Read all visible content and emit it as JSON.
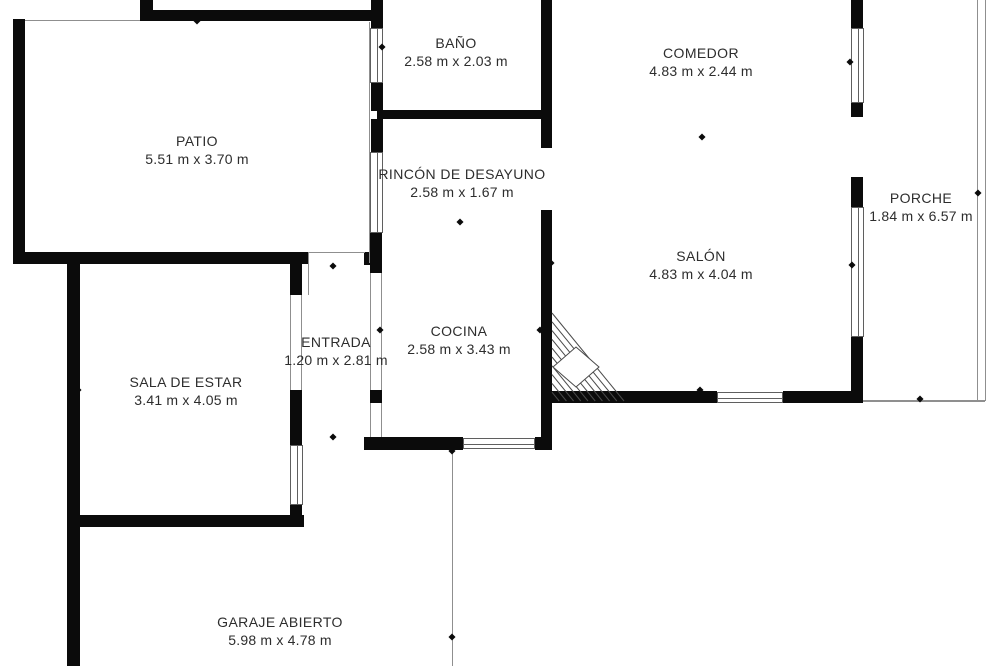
{
  "meta": {
    "width": 1000,
    "height": 666,
    "background_color": "#ffffff",
    "wall_color": "#0b0b0b",
    "thin_line_color": "#8f8f8f",
    "text_color": "#2d2d2d"
  },
  "rooms": [
    {
      "id": "patio",
      "name": "PATIO",
      "dims": "5.51 m x 3.70 m",
      "cx": 197,
      "cy": 150
    },
    {
      "id": "bano",
      "name": "BAÑO",
      "dims": "2.58 m x 2.03 m",
      "cx": 456,
      "cy": 52
    },
    {
      "id": "comedor",
      "name": "COMEDOR",
      "dims": "4.83 m x 2.44 m",
      "cx": 701,
      "cy": 62
    },
    {
      "id": "rincon",
      "name": "RINCÓN DE DESAYUNO",
      "dims": "2.58 m x 1.67 m",
      "cx": 462,
      "cy": 183
    },
    {
      "id": "salon",
      "name": "SALÓN",
      "dims": "4.83 m x 4.04 m",
      "cx": 701,
      "cy": 265
    },
    {
      "id": "porche",
      "name": "PORCHE",
      "dims": "1.84 m x 6.57 m",
      "cx": 921,
      "cy": 207
    },
    {
      "id": "entrada",
      "name": "ENTRADA",
      "dims": "1.20 m x 2.81 m",
      "cx": 336,
      "cy": 351
    },
    {
      "id": "cocina",
      "name": "COCINA",
      "dims": "2.58 m x 3.43 m",
      "cx": 459,
      "cy": 340
    },
    {
      "id": "sala",
      "name": "SALA DE ESTAR",
      "dims": "3.41 m x 4.05 m",
      "cx": 186,
      "cy": 391
    },
    {
      "id": "garaje",
      "name": "GARAJE ABIERTO",
      "dims": "5.98 m x 4.78 m",
      "cx": 280,
      "cy": 631
    }
  ],
  "walls": [
    [
      140,
      0,
      13,
      10
    ],
    [
      371,
      0,
      12,
      10
    ],
    [
      140,
      10,
      243,
      11
    ],
    [
      13,
      19,
      12,
      245
    ],
    [
      13,
      252,
      295,
      12
    ],
    [
      67,
      264,
      13,
      402
    ],
    [
      80,
      515,
      224,
      12
    ],
    [
      290,
      264,
      12,
      31
    ],
    [
      290,
      390,
      12,
      55
    ],
    [
      290,
      505,
      12,
      22
    ],
    [
      364,
      252,
      18,
      13
    ],
    [
      370,
      233,
      12,
      40
    ],
    [
      370,
      390,
      12,
      13
    ],
    [
      371,
      21,
      12,
      8
    ],
    [
      371,
      83,
      12,
      28
    ],
    [
      377,
      110,
      165,
      9
    ],
    [
      371,
      119,
      12,
      33
    ],
    [
      541,
      0,
      11,
      148
    ],
    [
      541,
      210,
      11,
      237
    ],
    [
      364,
      437,
      99,
      13
    ],
    [
      535,
      437,
      17,
      13
    ],
    [
      548,
      391,
      169,
      12
    ],
    [
      783,
      391,
      80,
      12
    ],
    [
      851,
      0,
      12,
      28
    ],
    [
      851,
      103,
      12,
      14
    ],
    [
      851,
      177,
      12,
      30
    ],
    [
      851,
      337,
      12,
      66
    ]
  ],
  "windows": [
    {
      "x": 370,
      "y": 28,
      "w": 13,
      "h": 55,
      "orient": "v"
    },
    {
      "x": 370,
      "y": 152,
      "w": 13,
      "h": 81,
      "orient": "v"
    },
    {
      "x": 851,
      "y": 28,
      "w": 13,
      "h": 75,
      "orient": "v"
    },
    {
      "x": 851,
      "y": 207,
      "w": 13,
      "h": 130,
      "orient": "v"
    },
    {
      "x": 290,
      "y": 445,
      "w": 13,
      "h": 60,
      "orient": "v"
    },
    {
      "x": 463,
      "y": 438,
      "w": 72,
      "h": 11,
      "orient": "h"
    },
    {
      "x": 717,
      "y": 392,
      "w": 66,
      "h": 11,
      "orient": "h"
    }
  ],
  "thin_lines": [
    [
      25,
      20,
      115,
      1
    ],
    [
      369,
      22,
      1,
      241
    ],
    [
      308,
      252,
      57,
      1
    ],
    [
      308,
      253,
      1,
      42
    ],
    [
      290,
      295,
      1,
      95
    ],
    [
      301,
      295,
      1,
      95
    ],
    [
      370,
      273,
      1,
      117
    ],
    [
      381,
      273,
      1,
      117
    ],
    [
      370,
      403,
      1,
      34
    ],
    [
      381,
      403,
      1,
      34
    ],
    [
      977,
      0,
      1,
      401
    ],
    [
      985,
      0,
      1,
      401
    ],
    [
      863,
      400,
      122,
      2
    ],
    [
      452,
      450,
      1,
      216
    ]
  ],
  "ticks": [
    [
      197,
      21
    ],
    [
      382,
      47
    ],
    [
      460,
      114
    ],
    [
      702,
      137
    ],
    [
      850,
      62
    ],
    [
      852,
      265
    ],
    [
      978,
      193
    ],
    [
      551,
      263
    ],
    [
      333,
      266
    ],
    [
      460,
      222
    ],
    [
      380,
      330
    ],
    [
      540,
      330
    ],
    [
      78,
      390
    ],
    [
      700,
      390
    ],
    [
      920,
      399
    ],
    [
      333,
      437
    ],
    [
      452,
      451
    ],
    [
      243,
      520
    ],
    [
      452,
      637
    ]
  ],
  "stairs": {
    "x": 548,
    "y": 305,
    "w": 80,
    "h": 100,
    "triangle": {
      "ax": 4,
      "ay": 8,
      "bx": 4,
      "by": 96,
      "cx": 76,
      "cy": 96
    },
    "hatch_count": 9,
    "diamond": [
      [
        28,
        42
      ],
      [
        51,
        62
      ],
      [
        28,
        82
      ],
      [
        5,
        62
      ]
    ],
    "stroke": "#4a4a4a"
  }
}
